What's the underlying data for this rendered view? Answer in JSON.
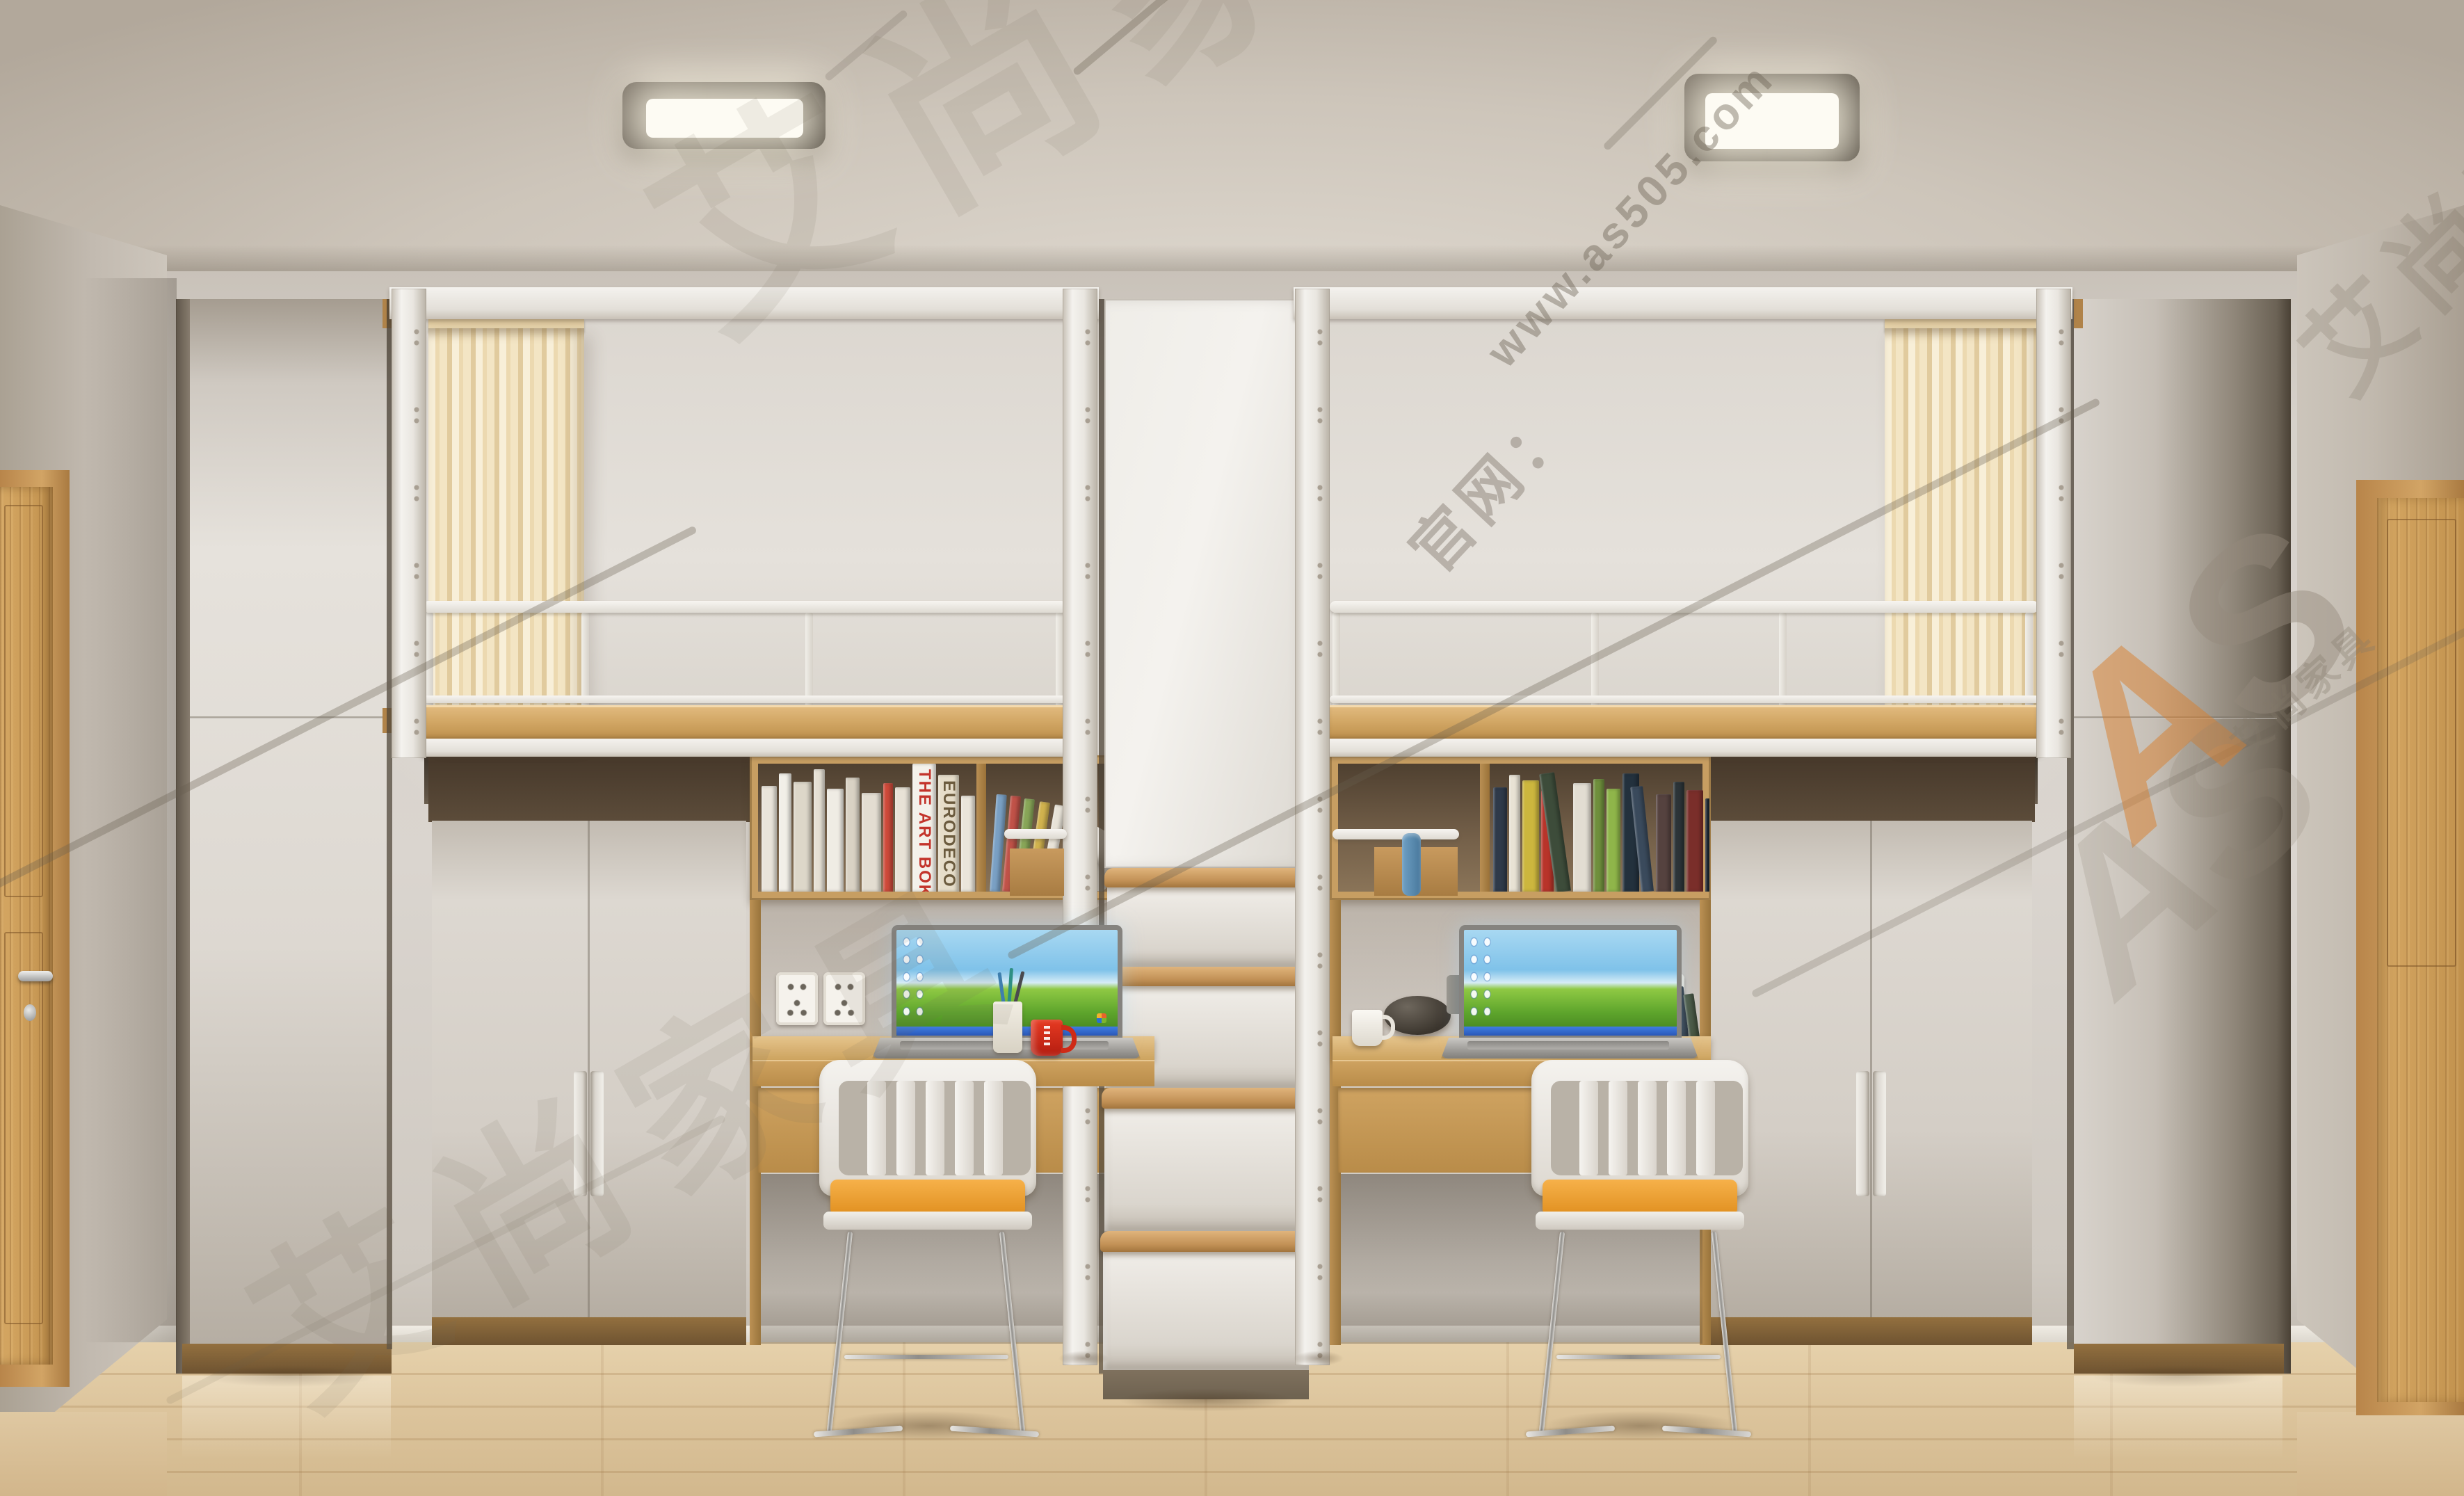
{
  "watermarks": {
    "url": "www.as505.com",
    "site_label": "官网：",
    "brand_cn": "艾尚家具",
    "logo_a": "A",
    "logo_s": "S",
    "logo_full": "AS",
    "accent_orange": "#d47e2c",
    "watermark_gray": "#6e6254"
  },
  "palette": {
    "wall": "#d6d1ca",
    "ceiling": "#cdc5ba",
    "floor_wood": "#ddc49c",
    "furniture_white": "#e3dfd9",
    "furniture_wood": "#c99e62",
    "fascia_wood": "#d2a765",
    "curtain_cream": "#f3e5c4",
    "chair_cushion_orange": "#f0a437",
    "mug_red": "#d8301f",
    "laptop_sky_blue": "#7fc2e9",
    "laptop_grass_green": "#5ea52c",
    "taskbar_blue": "#2a58b8",
    "door_wood": "#c9975a",
    "light_housing": "#574e43"
  },
  "counts": {
    "ceiling_lights": 2,
    "loft_beds": 2,
    "ladder_steps": 4,
    "chairs": 2,
    "desks": 2,
    "outlets_per_desk": 2,
    "tall_wardrobes": 2,
    "underbed_wardrobes": 2
  },
  "books": {
    "left_main": [
      {
        "w": 22,
        "h": 152,
        "c": "#e9e4da"
      },
      {
        "w": 18,
        "h": 170,
        "c": "#f2efe8"
      },
      {
        "w": 26,
        "h": 158,
        "c": "#ddd7c9"
      },
      {
        "w": 16,
        "h": 176,
        "c": "#e6e0d4"
      },
      {
        "w": 24,
        "h": 148,
        "c": "#efece4"
      },
      {
        "w": 20,
        "h": 164,
        "c": "#d9d2c4"
      },
      {
        "w": 28,
        "h": 142,
        "c": "#e3ddd1"
      },
      {
        "w": 14,
        "h": 156,
        "c": "#ce4a3a"
      },
      {
        "w": 22,
        "h": 150,
        "c": "#e8e2d6"
      },
      {
        "w": 34,
        "h": 184,
        "c": "#f4f1ea",
        "t": "THE ART BOK",
        "tc": "#c3342b"
      },
      {
        "w": 30,
        "h": 168,
        "c": "#e6ddc9",
        "t": "EURODECO",
        "tc": "#6b5b3e"
      },
      {
        "w": 20,
        "h": 138,
        "c": "#eae5da"
      },
      {
        "w": 18,
        "h": 126,
        "c": "#ded8cb",
        "r": 6
      }
    ],
    "left_side": [
      {
        "w": 15,
        "h": 140,
        "c": "#7aa0c4",
        "r": 4
      },
      {
        "w": 15,
        "h": 138,
        "c": "#c05248",
        "r": 5
      },
      {
        "w": 15,
        "h": 134,
        "c": "#88a658",
        "r": 6
      },
      {
        "w": 15,
        "h": 130,
        "c": "#d1b24e",
        "r": 8
      },
      {
        "w": 16,
        "h": 126,
        "c": "#e8e3d8",
        "r": 10
      }
    ],
    "right_main": [
      {
        "w": 20,
        "h": 150,
        "c": "#2f3a4a"
      },
      {
        "w": 16,
        "h": 168,
        "c": "#e8e2d4"
      },
      {
        "w": 24,
        "h": 160,
        "c": "#ccb63e"
      },
      {
        "w": 18,
        "h": 146,
        "c": "#b8342a"
      },
      {
        "w": 22,
        "h": 172,
        "c": "#3d4c3a",
        "r": -8
      },
      {
        "w": 26,
        "h": 156,
        "c": "#e2ddd2"
      },
      {
        "w": 16,
        "h": 162,
        "c": "#6f8f3c"
      },
      {
        "w": 20,
        "h": 148,
        "c": "#8fb54a"
      },
      {
        "w": 24,
        "h": 170,
        "c": "#23313d"
      },
      {
        "w": 18,
        "h": 152,
        "c": "#3a4a5c",
        "r": -6
      },
      {
        "w": 22,
        "h": 140,
        "c": "#55423f"
      },
      {
        "w": 16,
        "h": 158,
        "c": "#2c3438"
      },
      {
        "w": 24,
        "h": 146,
        "c": "#7a2e2a"
      },
      {
        "w": 20,
        "h": 134,
        "c": "#16202a"
      }
    ],
    "right_desk": [
      {
        "w": 15,
        "h": 146,
        "c": "#8c2f28",
        "r": -4
      },
      {
        "w": 14,
        "h": 138,
        "c": "#2b3642",
        "r": -6
      },
      {
        "w": 15,
        "h": 128,
        "c": "#45523c",
        "r": -8
      }
    ]
  }
}
